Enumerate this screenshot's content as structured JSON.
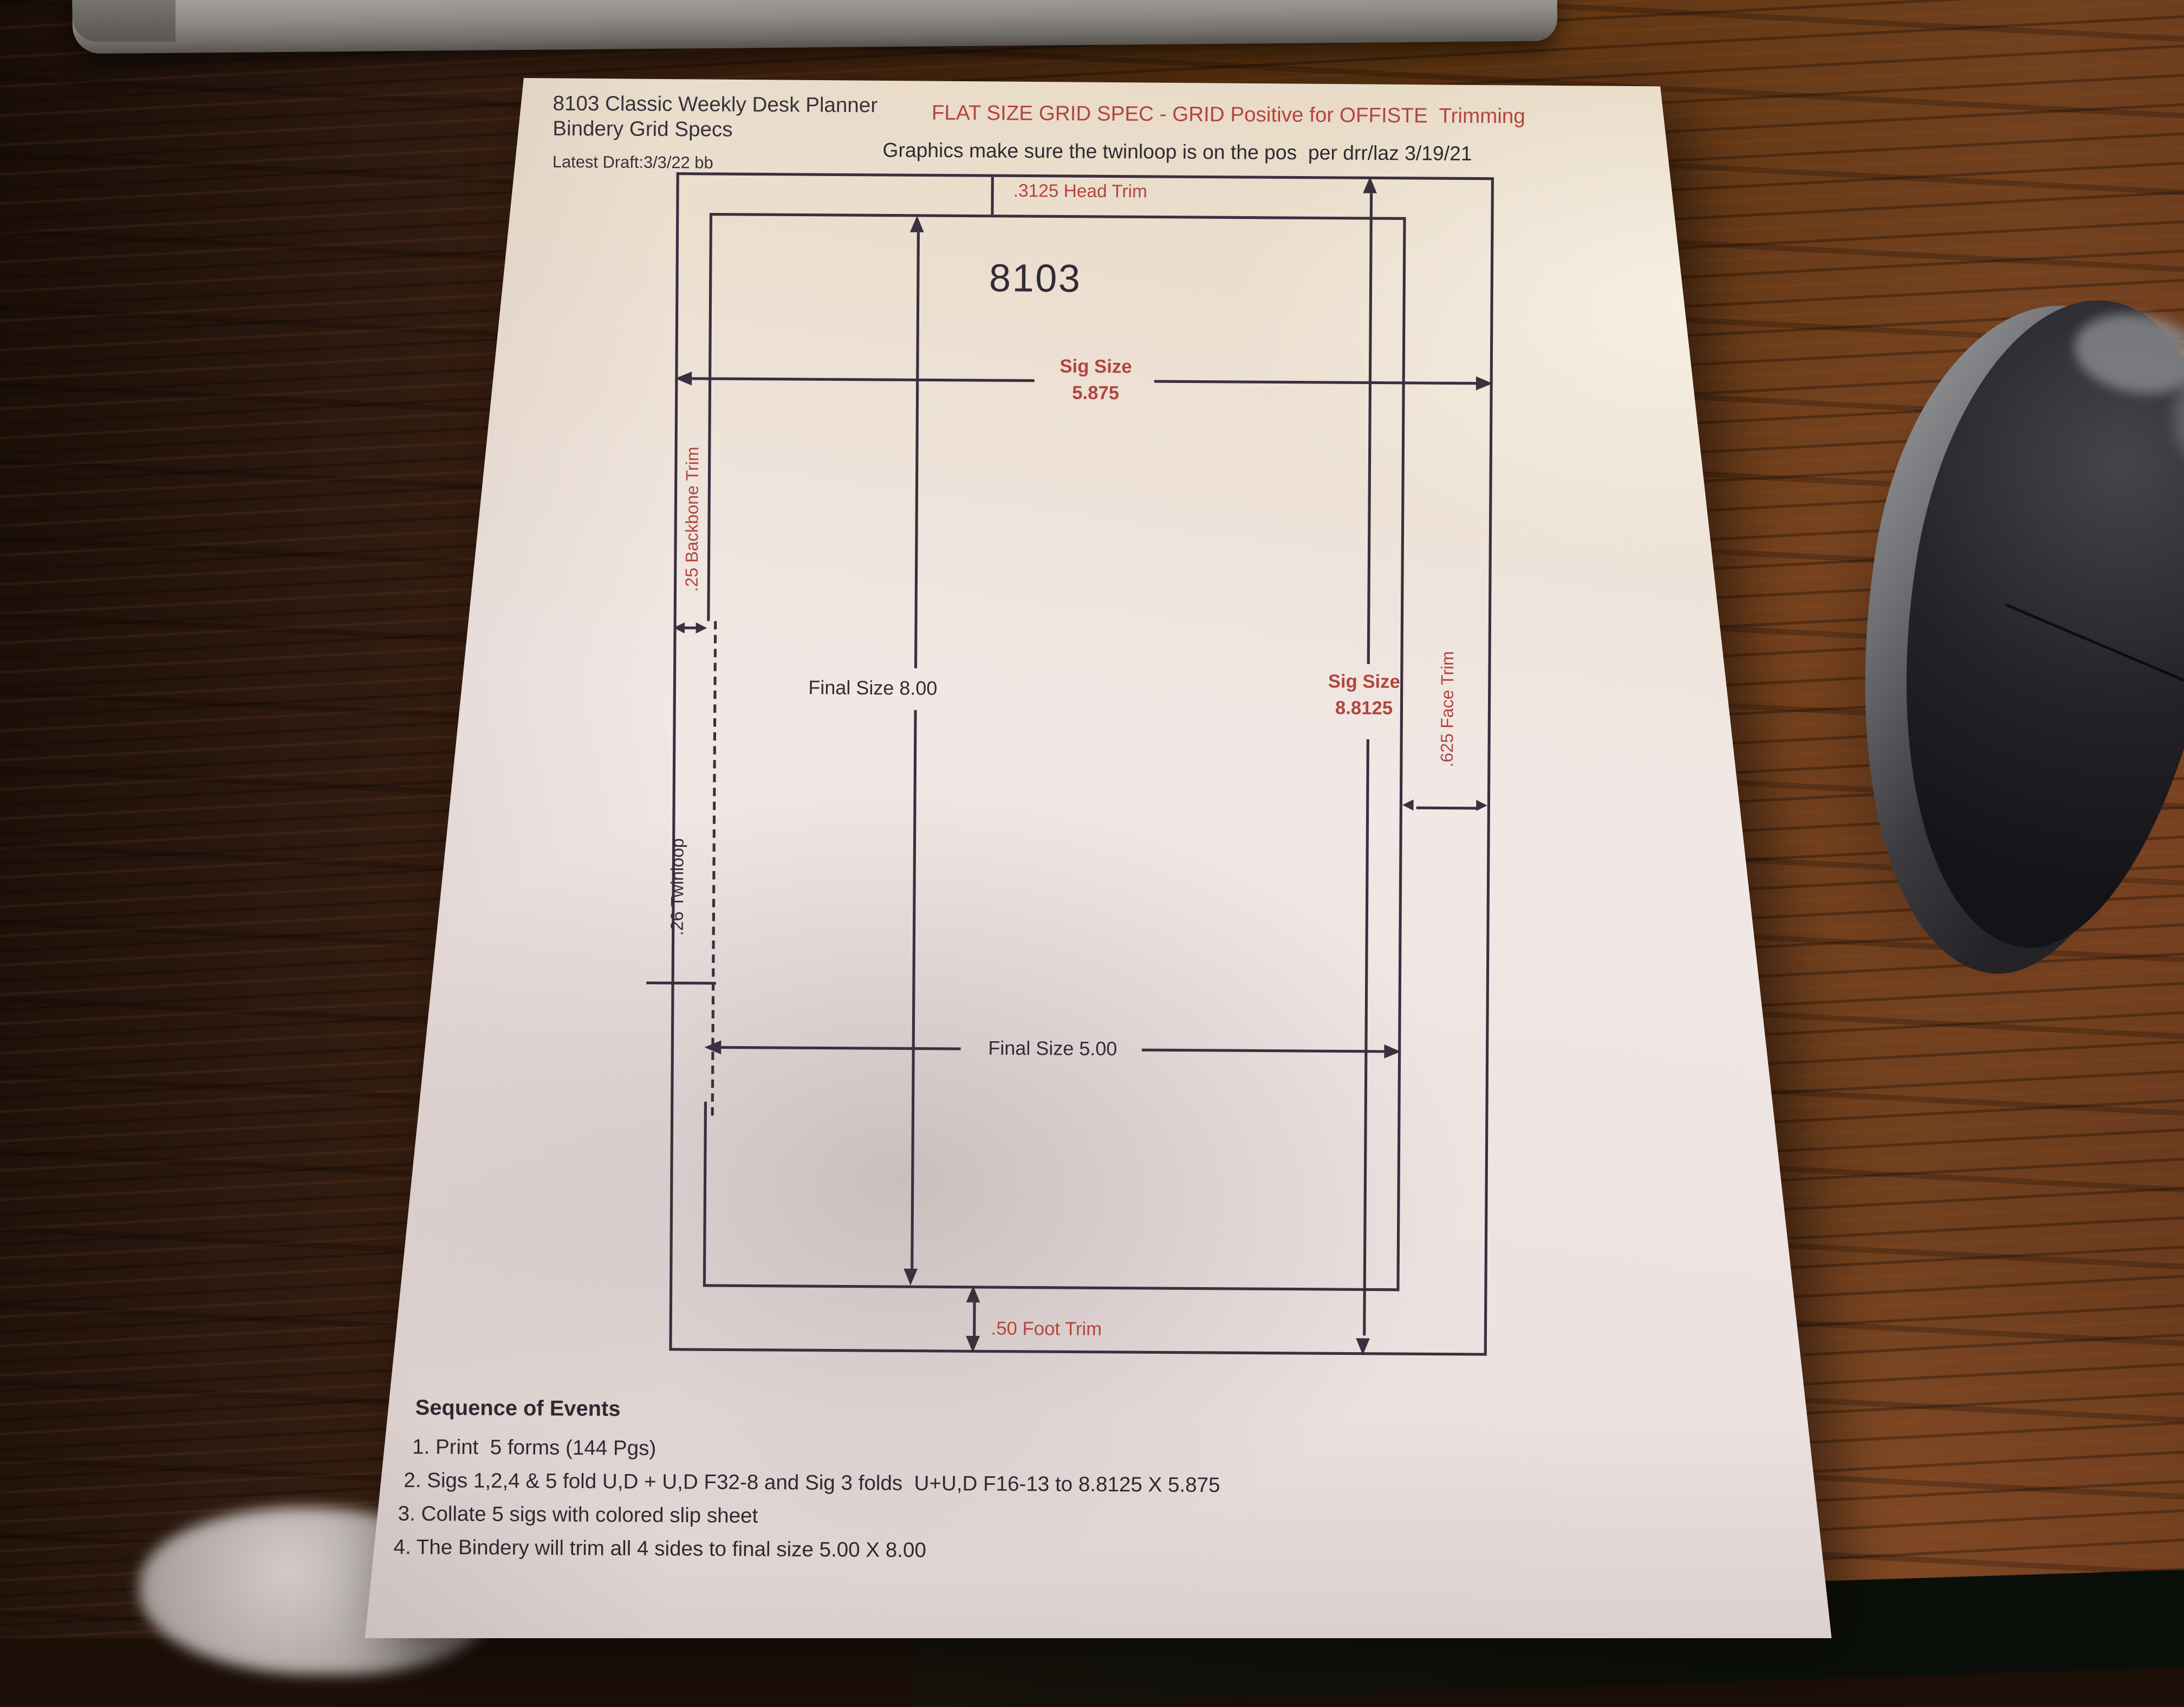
{
  "scene": {
    "colors": {
      "ink": "#3a3040",
      "red": "#b2453f",
      "paper": "#efe7e3",
      "wood_dark": "#2c1910",
      "wood_light": "#71401f"
    }
  },
  "paper": {
    "header": {
      "title_line1": "8103 Classic Weekly Desk Planner",
      "title_line2": "Bindery Grid Specs",
      "red_title": "FLAT SIZE GRID SPEC - GRID Positive for OFFISTE  Trimming",
      "draft_note": "Latest Draft:3/3/22 bb",
      "graphics_note": "Graphics make sure the twinloop is on the pos  per drr/laz 3/19/21"
    },
    "diagram": {
      "product_number": "8103",
      "head_trim": ".3125 Head Trim",
      "sig_width": {
        "label": "Sig Size",
        "value": "5.875"
      },
      "sig_height": {
        "label": "Sig Size",
        "value": "8.8125"
      },
      "final_height": "Final Size 8.00",
      "final_width": "Final Size 5.00",
      "backbone_trim": ".25 Backbone Trim",
      "face_trim": ".625 Face Trim",
      "twinloop": ".26 Twinloop",
      "foot_trim": ".50 Foot Trim"
    },
    "sequence": {
      "heading": "Sequence of Events",
      "items": [
        "1. Print  5 forms (144 Pgs)",
        "2. Sigs 1,2,4 & 5 fold U,D + U,D F32-8 and Sig 3 folds  U+U,D F16-13 to 8.8125 X 5.875",
        "3. Collate 5 sigs with colored slip sheet",
        "4. The Bindery will trim all 4 sides to final size 5.00 X 8.00"
      ]
    }
  }
}
